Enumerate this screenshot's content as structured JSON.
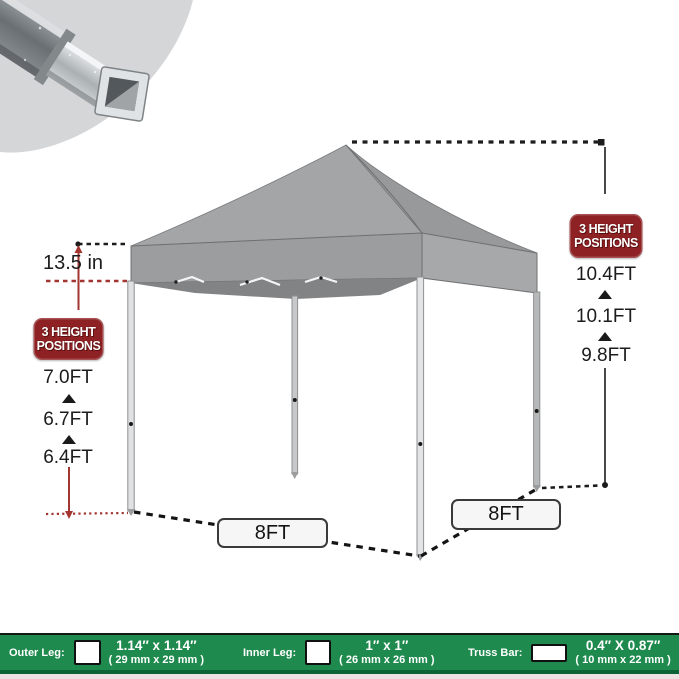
{
  "measurements": {
    "valance_height": "13.5 in",
    "left_badge_line1": "3 HEIGHT",
    "left_badge_line2": "POSITIONS",
    "right_badge_line1": "3 HEIGHT",
    "right_badge_line2": "POSITIONS",
    "leg_heights": [
      "7.0FT",
      "6.7FT",
      "6.4FT"
    ],
    "peak_heights": [
      "10.4FT",
      "10.1FT",
      "9.8FT"
    ],
    "base_width_front": "8FT",
    "base_width_side": "8FT"
  },
  "spec_bar": {
    "items": [
      {
        "label": "Outer Leg:",
        "size": "1.14″ x 1.14″",
        "metric": "( 29 mm x 29 mm )",
        "icon": "square-outline-icon"
      },
      {
        "label": "Inner Leg:",
        "size": "1″ x 1″",
        "metric": "( 26 mm x 26 mm )",
        "icon": "square-outline-icon"
      },
      {
        "label": "Truss Bar:",
        "size": "0.4″ X 0.87″",
        "metric": "( 10 mm x 22 mm )",
        "icon": "rect-outline-icon"
      }
    ]
  },
  "colors": {
    "badge_red": "#8e2123",
    "accent_red": "#a33630",
    "bar_green": "#1f8a4e",
    "bar_green_dark": "#0c6336",
    "canopy_gray": "#9c9d9f",
    "line_black": "#1c1c1c"
  }
}
